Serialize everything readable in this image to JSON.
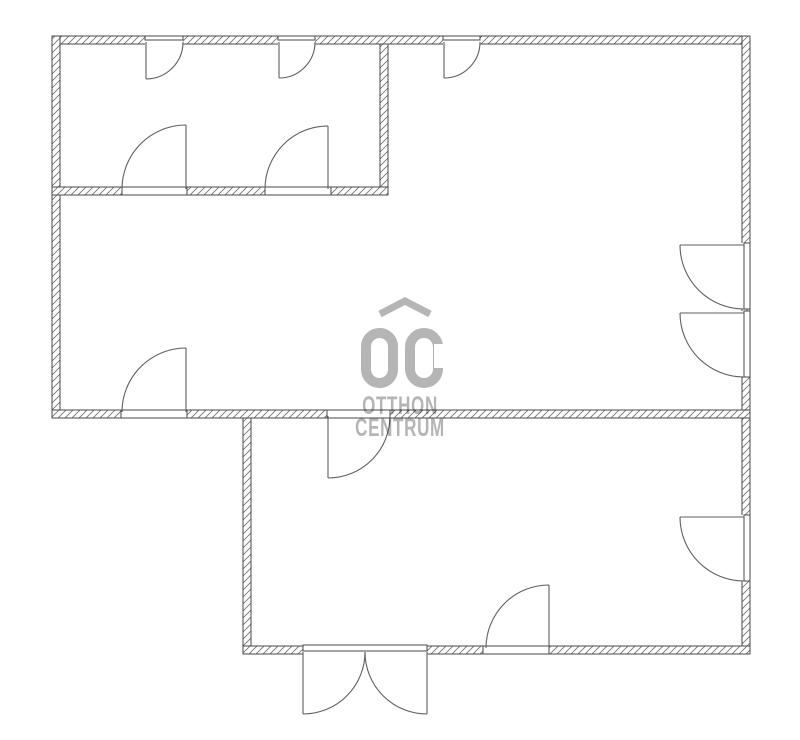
{
  "watermark": {
    "brand_mark": "OC",
    "line1": "OTTHON",
    "line2": "CENTRUM",
    "color": "#b5b5b5"
  },
  "plan": {
    "canvas": {
      "width": 800,
      "height": 740
    },
    "colors": {
      "background": "#ffffff",
      "wall_stroke": "#4a4a4a",
      "hatch": "#757575",
      "door": "#5f5f5f"
    },
    "walls": [
      {
        "name": "top-exterior-wall",
        "x": 52,
        "y": 36,
        "w": 698,
        "h": 8
      },
      {
        "name": "left-exterior-wall",
        "x": 52,
        "y": 36,
        "w": 8,
        "h": 382
      },
      {
        "name": "right-exterior-wall",
        "x": 742,
        "y": 36,
        "w": 8,
        "h": 618
      },
      {
        "name": "small-room-bottom-wall",
        "x": 52,
        "y": 187,
        "w": 336,
        "h": 8
      },
      {
        "name": "small-room-divider-wall",
        "x": 380,
        "y": 44,
        "w": 8,
        "h": 143
      },
      {
        "name": "middle-bottom-wall",
        "x": 52,
        "y": 410,
        "w": 698,
        "h": 8
      },
      {
        "name": "bottom-room-left-wall",
        "x": 243,
        "y": 418,
        "w": 8,
        "h": 236
      },
      {
        "name": "bottom-exterior-wall",
        "x": 243,
        "y": 646,
        "w": 507,
        "h": 8
      }
    ],
    "openings": [
      {
        "name": "opening-top-1",
        "dir": "h",
        "x": 145,
        "y": 36,
        "w": 38,
        "h": 8,
        "frame": [
          145,
          36,
          38,
          4
        ]
      },
      {
        "name": "opening-top-2",
        "dir": "h",
        "x": 278,
        "y": 36,
        "w": 37,
        "h": 8,
        "frame": [
          278,
          36,
          37,
          4
        ]
      },
      {
        "name": "opening-top-3",
        "dir": "h",
        "x": 443,
        "y": 36,
        "w": 37,
        "h": 8,
        "frame": [
          443,
          36,
          37,
          4
        ]
      },
      {
        "name": "opening-right-1",
        "dir": "v",
        "x": 742,
        "y": 243,
        "w": 8,
        "h": 66,
        "frame": [
          744,
          243,
          6,
          66
        ]
      },
      {
        "name": "opening-right-2",
        "dir": "v",
        "x": 742,
        "y": 311,
        "w": 8,
        "h": 66,
        "frame": [
          744,
          311,
          6,
          66
        ]
      },
      {
        "name": "opening-right-3",
        "dir": "v",
        "x": 742,
        "y": 515,
        "w": 8,
        "h": 66,
        "frame": [
          744,
          515,
          6,
          66
        ]
      },
      {
        "name": "opening-smallroom-1",
        "dir": "h",
        "x": 122,
        "y": 187,
        "w": 65,
        "h": 8,
        "frame": [
          122,
          187,
          65,
          8
        ]
      },
      {
        "name": "opening-smallroom-2",
        "dir": "h",
        "x": 265,
        "y": 187,
        "w": 66,
        "h": 8,
        "frame": [
          265,
          187,
          66,
          8
        ]
      },
      {
        "name": "opening-middle-left",
        "dir": "h",
        "x": 121,
        "y": 410,
        "w": 66,
        "h": 8,
        "frame": [
          121,
          410,
          66,
          8
        ]
      },
      {
        "name": "opening-bottom-room",
        "dir": "h",
        "x": 327,
        "y": 410,
        "w": 63,
        "h": 8,
        "frame": [
          327,
          410,
          63,
          8
        ]
      },
      {
        "name": "opening-entry-double",
        "dir": "h",
        "x": 303,
        "y": 646,
        "w": 124,
        "h": 8,
        "frame": [
          303,
          645,
          124,
          6
        ]
      },
      {
        "name": "opening-bottom-single",
        "dir": "h",
        "x": 483,
        "y": 646,
        "w": 66,
        "h": 8,
        "frame": [
          483,
          646,
          66,
          8
        ]
      }
    ],
    "doors": [
      {
        "name": "door-top-1",
        "leaf": [
          146,
          42,
          146,
          79
        ],
        "end": [
          183,
          42
        ],
        "r": 37,
        "sweep": 0
      },
      {
        "name": "door-top-2",
        "leaf": [
          279,
          42,
          279,
          78
        ],
        "end": [
          315,
          42
        ],
        "r": 36,
        "sweep": 0
      },
      {
        "name": "door-top-3",
        "leaf": [
          444,
          42,
          444,
          78
        ],
        "end": [
          480,
          42
        ],
        "r": 36,
        "sweep": 0
      },
      {
        "name": "door-right-1",
        "leaf": [
          744,
          245,
          680,
          245
        ],
        "end": [
          744,
          309
        ],
        "r": 64,
        "sweep": 0
      },
      {
        "name": "door-right-2",
        "leaf": [
          744,
          313,
          680,
          313
        ],
        "end": [
          744,
          377
        ],
        "r": 64,
        "sweep": 0
      },
      {
        "name": "door-right-3",
        "leaf": [
          744,
          517,
          680,
          517
        ],
        "end": [
          744,
          581
        ],
        "r": 64,
        "sweep": 0
      },
      {
        "name": "door-smallroom-1",
        "leaf": [
          186,
          189,
          186,
          125
        ],
        "end": [
          122,
          189
        ],
        "r": 64,
        "sweep": 0
      },
      {
        "name": "door-smallroom-2",
        "leaf": [
          328,
          189,
          328,
          126
        ],
        "end": [
          265,
          189
        ],
        "r": 63,
        "sweep": 0
      },
      {
        "name": "door-middle-left",
        "leaf": [
          186,
          412,
          186,
          348
        ],
        "end": [
          122,
          412
        ],
        "r": 64,
        "sweep": 0
      },
      {
        "name": "door-bottom-room",
        "leaf": [
          328,
          416,
          328,
          478
        ],
        "end": [
          390,
          416
        ],
        "r": 62,
        "sweep": 0
      },
      {
        "name": "door-entry-left",
        "leaf": [
          303,
          652,
          303,
          714
        ],
        "end": [
          365,
          652
        ],
        "r": 62,
        "sweep": 0
      },
      {
        "name": "door-entry-right",
        "leaf": [
          427,
          652,
          427,
          714
        ],
        "end": [
          365,
          652
        ],
        "r": 62,
        "sweep": 1
      },
      {
        "name": "door-bottom-single",
        "leaf": [
          549,
          648,
          549,
          585
        ],
        "end": [
          486,
          648
        ],
        "r": 63,
        "sweep": 0
      }
    ]
  }
}
